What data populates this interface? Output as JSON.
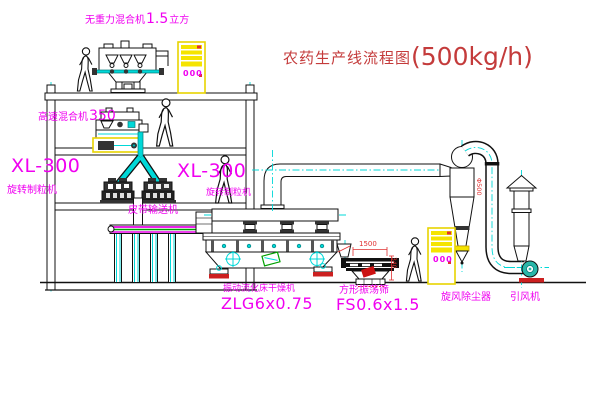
{
  "title": {
    "name": "农药生产线流程图",
    "capacity": "(500kg/h)"
  },
  "labels": {
    "no_gravity_mixer": {
      "name": "无重力混合机",
      "size": "1.5",
      "unit": "立方"
    },
    "high_speed_mixer": {
      "name": "高速混合机",
      "size": "350"
    },
    "granulator_left": {
      "model": "XL-300",
      "name": "旋转制粒机"
    },
    "granulator_right": {
      "model": "XL-300",
      "name": "旋转制粒机"
    },
    "belt_conveyor": "皮带输送机",
    "dryer": {
      "name": "振动流化床干燥机",
      "model": "ZLG6x0.75"
    },
    "sieve": {
      "name": "方形振荡筛",
      "model": "FS0.6x1.5"
    },
    "cyclone": "旋风除尘器",
    "fan": "引风机"
  },
  "dimensions": {
    "sieve_width": "1500",
    "sieve_height": "340",
    "cyclone_diameter": "Φ500"
  },
  "cabinet": {
    "display": "000"
  },
  "colors": {
    "label_magenta": "#f000f0",
    "title_red": "#c43b3b",
    "dimension_red": "#e03030",
    "centerline_cyan": "#00d8d8",
    "cabinet_yellow": "#f0e000"
  }
}
